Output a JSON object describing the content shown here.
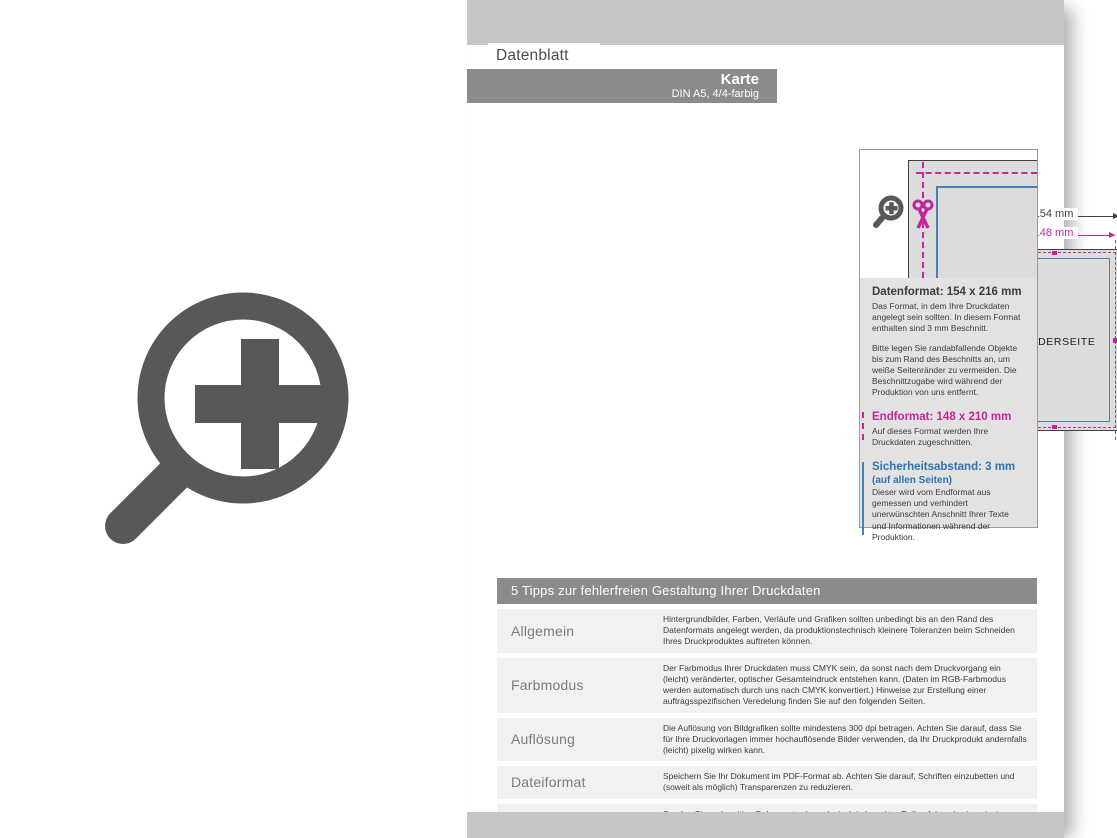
{
  "header": {
    "tab": "Datenblatt",
    "title": "Karte",
    "subtitle": "DIN A5, 4/4-farbig"
  },
  "diagrams": {
    "front": {
      "label": "VORDERSEITE",
      "outer_width": "154 mm",
      "trim_width": "148 mm",
      "outer_height": "216mm",
      "trim_height": "210 mm"
    },
    "back": {
      "label": "RÜCKSEITE",
      "outer_width": "154 mm",
      "trim_width": "148 mm",
      "outer_height": "216mm",
      "trim_height": "210 mm"
    }
  },
  "info_box": {
    "datenformat": {
      "title": "Datenformat: 154 x 216 mm",
      "p1": "Das Format, in dem Ihre Druckdaten angelegt sein sollten. In diesem Format enthalten sind 3 mm Beschnitt.",
      "p2": "Bitte legen Sie randabfallende Objekte bis zum Rand des Beschnitts an, um weiße Seitenränder zu vermeiden. Die Beschnittzugabe wird während der Produktion von uns entfernt."
    },
    "endformat": {
      "title": "Endformat: 148 x 210 mm",
      "p1": "Auf dieses Format werden Ihre Druckdaten zugeschnitten."
    },
    "sicherheitsabstand": {
      "title": "Sicherheitsabstand: 3 mm",
      "subtitle": "(auf allen Seiten)",
      "p1": "Dieser wird vom Endformat aus gemessen und verhindert unerwünschten Anschnitt Ihrer Texte und Informationen während der Produktion."
    }
  },
  "tips": {
    "title": "5 Tipps zur fehlerfreien Gestaltung Ihrer Druckdaten",
    "rows": [
      {
        "label": "Allgemein",
        "text": "Hintergrundbilder, Farben, Verläufe und Grafiken sollten unbedingt bis an den Rand des Datenformats angelegt werden, da produktionstechnisch kleinere Toleranzen beim Schneiden Ihres Druckproduktes auftreten können."
      },
      {
        "label": "Farbmodus",
        "text": "Der Farbmodus Ihrer Druckdaten muss CMYK sein, da sonst nach dem Druckvorgang ein (leicht) veränderter, optischer Gesamteindruck entstehen kann. (Daten im RGB-Farbmodus werden automatisch durch uns nach CMYK konvertiert.) Hinweise zur Erstellung einer auftragsspezifischen Veredelung finden Sie auf den folgenden Seiten."
      },
      {
        "label": "Auflösung",
        "text": "Die Auflösung von Bildgrafiken sollte mindestens 300 dpi betragen. Achten Sie darauf, dass Sie für Ihre Druckvorlagen immer hochauflösende Bilder verwenden, da Ihr Druckprodukt andernfalls (leicht) pixelig wirken kann."
      },
      {
        "label": "Dateiformat",
        "text": "Speichern Sie Ihr Dokument im PDF-Format ab. Achten Sie darauf, Schriften einzubetten und (soweit als möglich) Transparenzen zu reduzieren."
      },
      {
        "label": "Seiten(-reihenfolge)",
        "text": "Senden Sie mehrseitige Dokumente chronologisch in korrekter Reihenfolge als eine einzige PDF-Datei oder benennen Sie Einzeldokumente entsprechend mit fortlaufenden Seitennummern."
      }
    ]
  },
  "icons": {
    "big_magnifier": "zoom-plus-icon",
    "small_magnifier": "zoom-plus-icon",
    "scissors": "scissors-icon"
  },
  "colors": {
    "magenta": "#c4259e",
    "blue": "#4a7fb5",
    "blue_text": "#2e73b2",
    "bar_dark": "#8b8b8b",
    "bar_light": "#c6c6c6",
    "icon_gray": "#58585a",
    "card_fill": "#dcdcdc",
    "row_bg": "#f1f1f1",
    "info_bg": "#e2e2e2"
  }
}
